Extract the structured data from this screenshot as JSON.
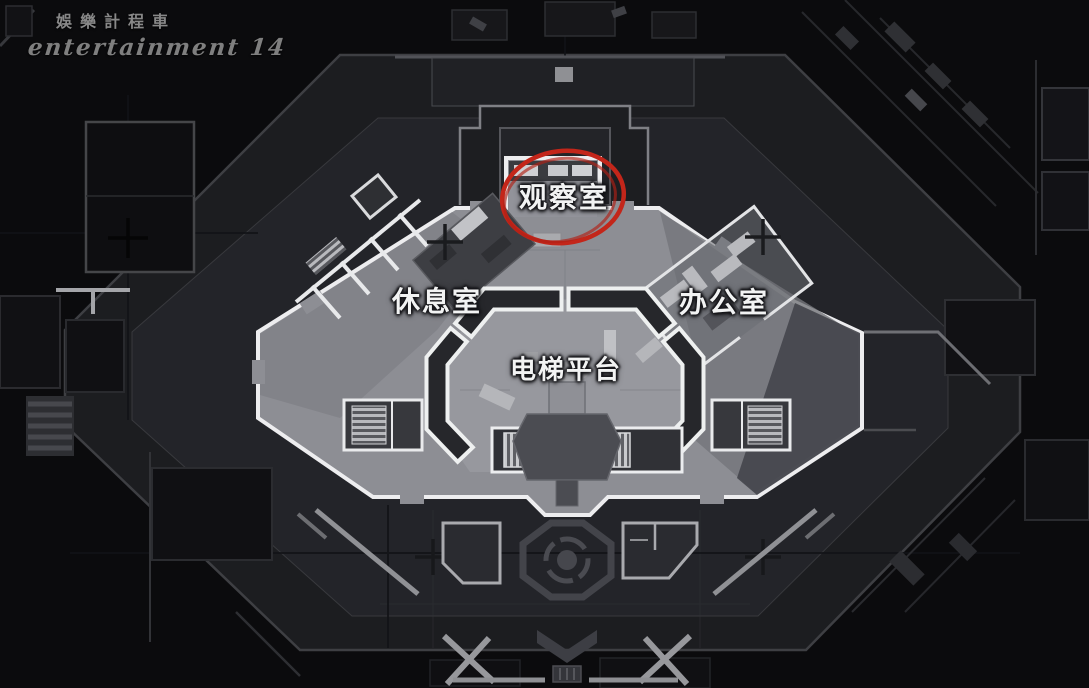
{
  "watermark": {
    "line1": "娛樂計程車",
    "line2": "entertainment 14"
  },
  "map": {
    "rooms": [
      {
        "id": "observation-room",
        "label": "观察室"
      },
      {
        "id": "lounge",
        "label": "休息室"
      },
      {
        "id": "office",
        "label": "办公室"
      },
      {
        "id": "elevator-platform",
        "label": "电梯平台"
      }
    ],
    "annotation": {
      "shape": "hand-drawn-ellipse",
      "target": "观察室",
      "color": "#c3261a"
    },
    "colors": {
      "background": "#0b0b0d",
      "plaza": "#1c1d20",
      "plaza_inner": "#24252a",
      "building_floor": "#8d8e94",
      "walls_white": "#ededef",
      "walls_dark": "#26272b",
      "label_text": "#f2f3f3",
      "annotation_red": "#c3261a",
      "watermark_grey": "#9a9a9a"
    }
  }
}
